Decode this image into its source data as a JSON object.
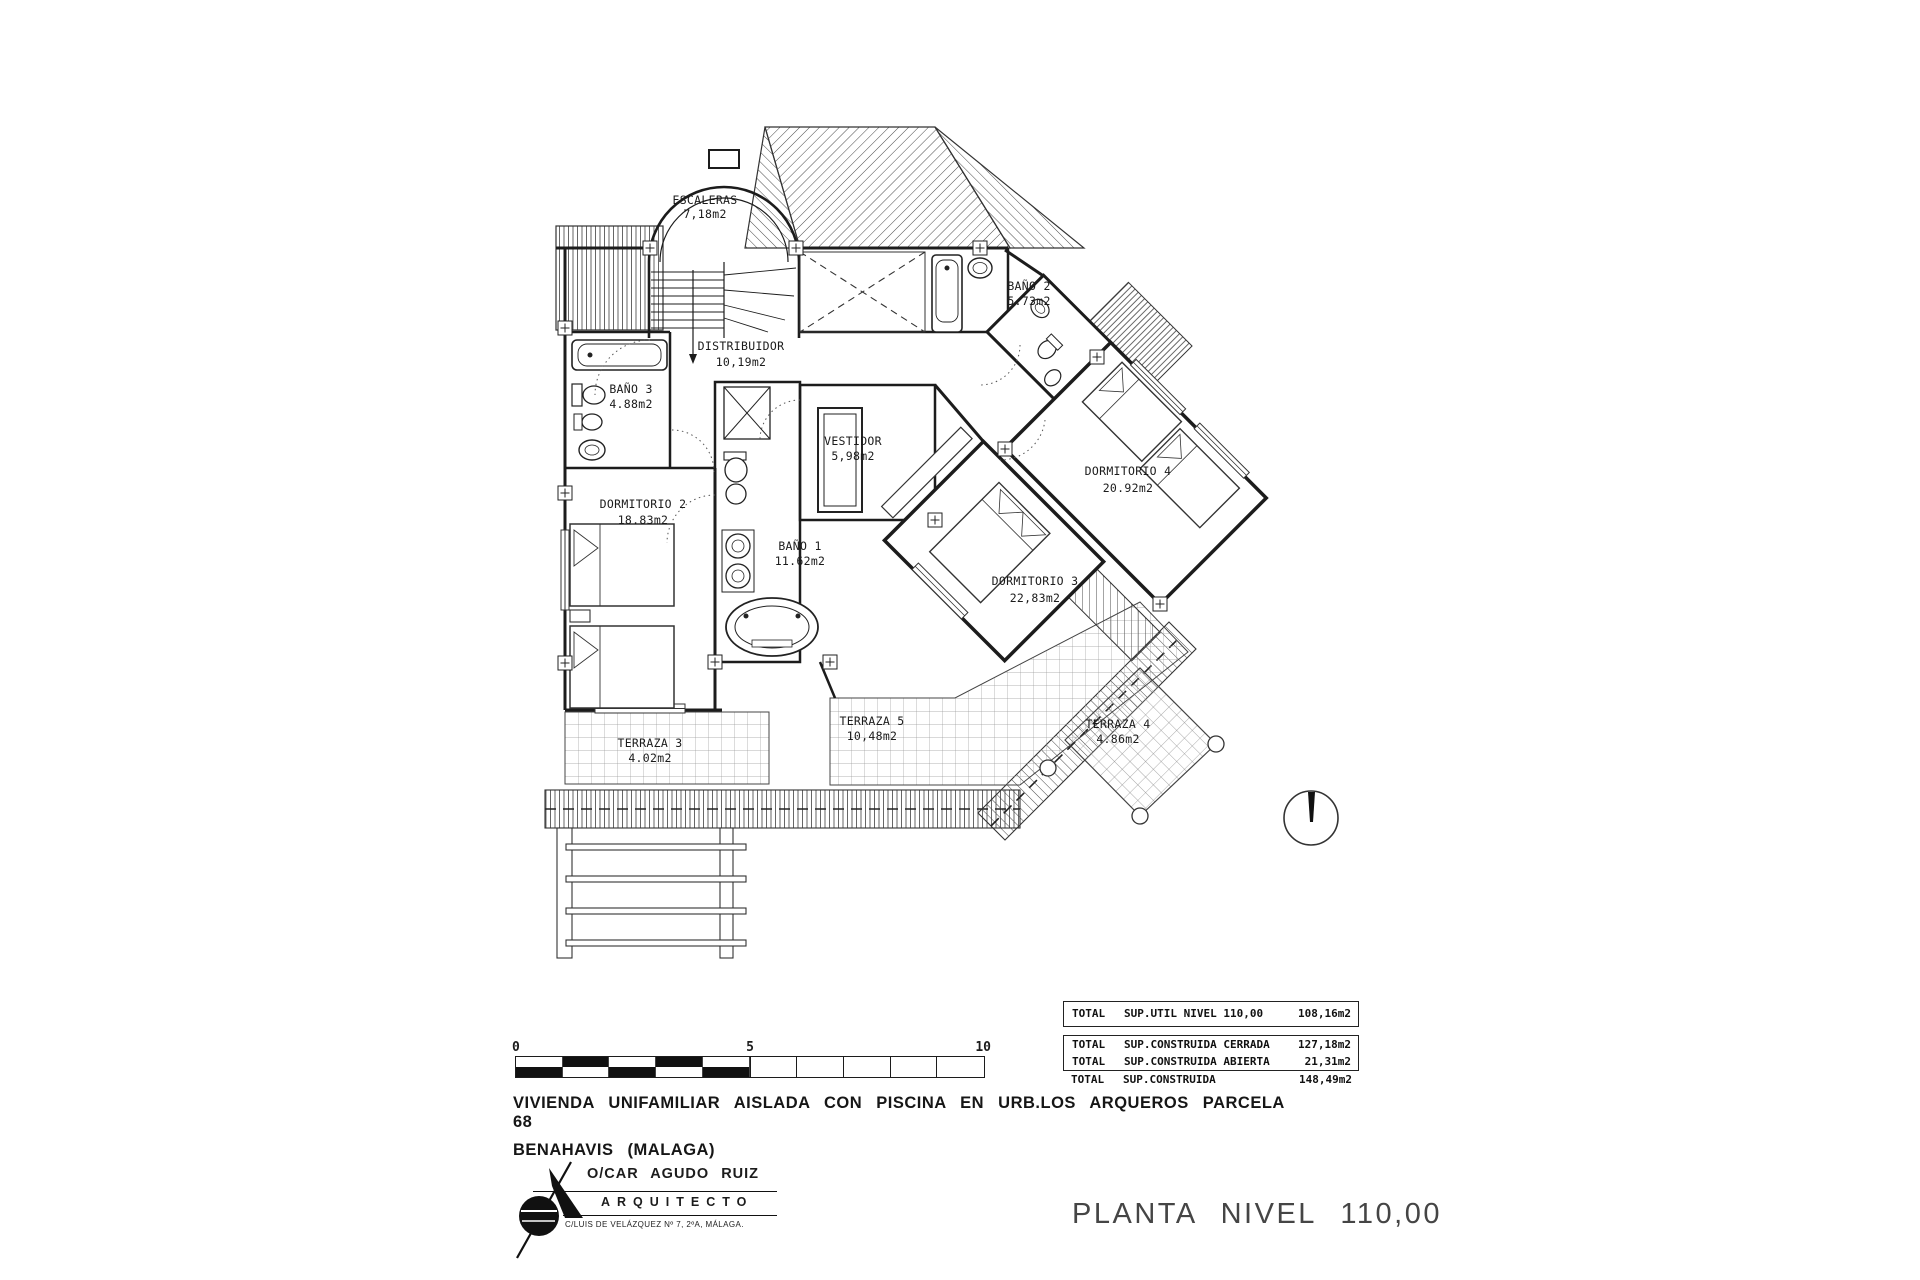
{
  "plan": {
    "rooms": [
      {
        "id": "escaleras",
        "name": "ESCALERAS",
        "area": "7,18m2"
      },
      {
        "id": "distribuidor",
        "name": "DISTRIBUIDOR",
        "area": "10,19m2"
      },
      {
        "id": "bano-2",
        "name": "BAÑO 2",
        "area": "5.73m2"
      },
      {
        "id": "bano-3",
        "name": "BAÑO 3",
        "area": "4.88m2"
      },
      {
        "id": "dormitorio-2",
        "name": "DORMITORIO 2",
        "area": "18.83m2"
      },
      {
        "id": "vestidor",
        "name": "VESTIDOR",
        "area": "5,98m2"
      },
      {
        "id": "bano-1",
        "name": "BAÑO 1",
        "area": "11.62m2"
      },
      {
        "id": "dormitorio-4",
        "name": "DORMITORIO 4",
        "area": "20.92m2"
      },
      {
        "id": "dormitorio-3",
        "name": "DORMITORIO 3",
        "area": "22,83m2"
      },
      {
        "id": "terraza-3",
        "name": "TERRAZA 3",
        "area": "4.02m2"
      },
      {
        "id": "terraza-5",
        "name": "TERRAZA 5",
        "area": "10,48m2"
      },
      {
        "id": "terraza-4",
        "name": "TERRAZA 4",
        "area": "4.86m2"
      }
    ]
  },
  "scale_bar": {
    "labels": [
      "0",
      "5",
      "10"
    ]
  },
  "summary": {
    "rows": [
      {
        "c1": "TOTAL",
        "c2": "SUP.UTIL NIVEL 110,00",
        "c3": "108,16m2"
      },
      {
        "c1": "TOTAL",
        "c2": "SUP.CONSTRUIDA CERRADA",
        "c3": "127,18m2"
      },
      {
        "c1": "TOTAL",
        "c2": "SUP.CONSTRUIDA ABIERTA",
        "c3": "21,31m2"
      },
      {
        "c1": "TOTAL",
        "c2": "SUP.CONSTRUIDA",
        "c3": "148,49m2"
      }
    ]
  },
  "title_block": {
    "line1": "VIVIENDA UNIFAMILIAR AISLADA CON PISCINA EN URB.LOS ARQUEROS PARCELA 68",
    "line2": "BENAHAVIS (MALAGA)"
  },
  "architect": {
    "name": "O/CAR AGUDO RUIZ",
    "role": "ARQUITECTO",
    "address": "C/LUIS DE VELÁZQUEZ Nº 7, 2ºA, MÁLAGA."
  },
  "drawing_title": {
    "text": "PLANTA NIVEL 110,00"
  },
  "colors": {
    "ink": "#1c1c1c",
    "hatch": "#4a4a4a",
    "grid": "#9a9a9a"
  }
}
